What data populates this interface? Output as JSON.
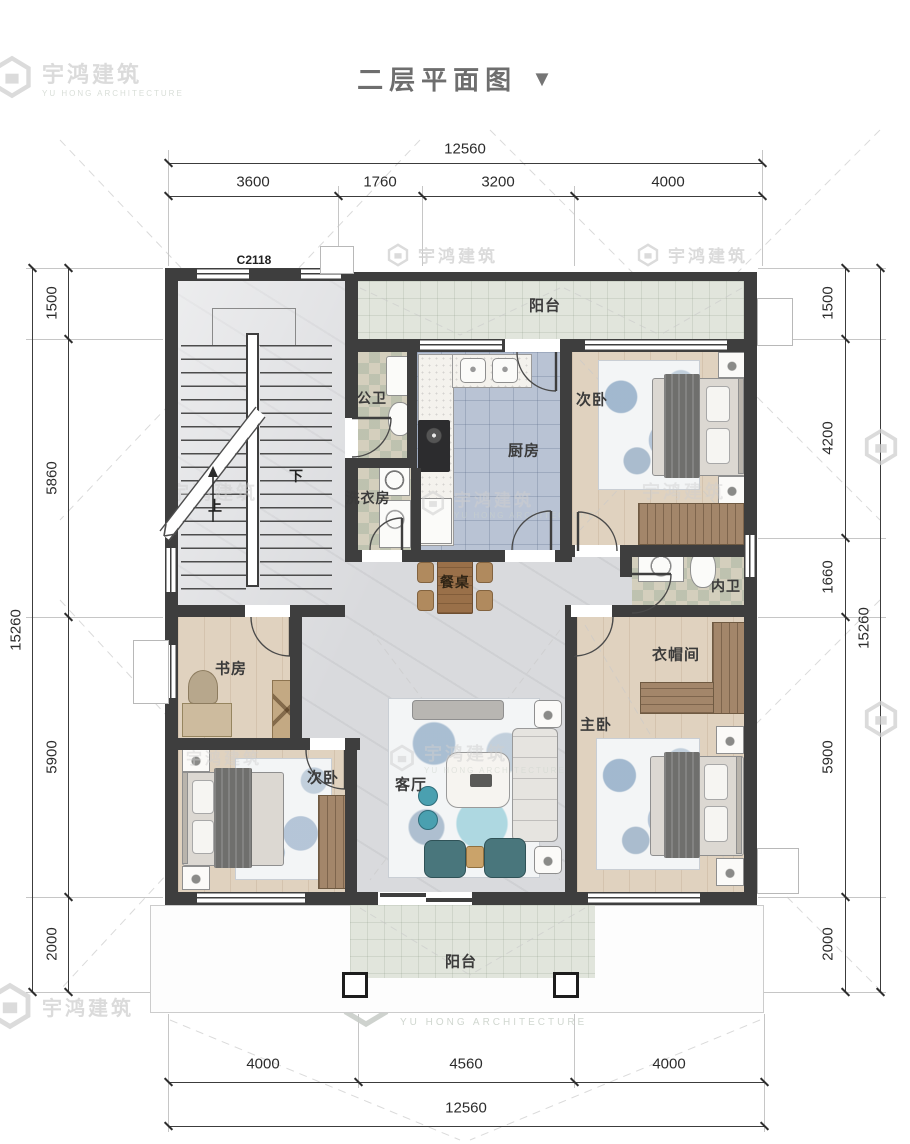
{
  "title": {
    "text": "二层平面图",
    "arrow": "▼"
  },
  "window_code": "C2118",
  "watermark": {
    "cn": "宇鸿建筑",
    "en": "YU HONG ARCHITECTURE"
  },
  "rooms": {
    "balcony_top": "阳台",
    "public_bath": "公卫",
    "kitchen": "厨房",
    "bedroom_top_right": "次卧",
    "laundry": "洗衣房",
    "dining_table": "餐桌",
    "ensuite_bath": "内卫",
    "study": "书房",
    "cloakroom": "衣帽间",
    "master_bedroom": "主卧",
    "bedroom_bottom_left": "次卧",
    "living_room": "客厅",
    "balcony_bottom": "阳台"
  },
  "stairs": {
    "down": "下",
    "up": "上"
  },
  "dimensions": {
    "top": {
      "total": "12560",
      "segments": [
        "3600",
        "1760",
        "3200",
        "4000"
      ]
    },
    "bottom": {
      "total": "12560",
      "segments": [
        "4000",
        "4560",
        "4000"
      ]
    },
    "left": {
      "total": "15260",
      "segments": [
        "1500",
        "5860",
        "5900",
        "2000"
      ]
    },
    "right": {
      "total": "15260",
      "segments": [
        "1500",
        "4200",
        "1660",
        "5900",
        "2000"
      ]
    }
  },
  "colors": {
    "wall": "#3e3e3e",
    "wood_floor": "#e0d2bf",
    "marble_floor": "#d9dadd",
    "kitchen_tile": "#b9c3d4",
    "bath_tile": "#d4cfbd",
    "balcony_tile": "#e1e5dc",
    "wardrobe": "#a3866a",
    "accent_teal": "#49767c",
    "dim_text": "#2c2c2c",
    "watermark": "#cfcfcf",
    "title": "#6e6e6e"
  }
}
